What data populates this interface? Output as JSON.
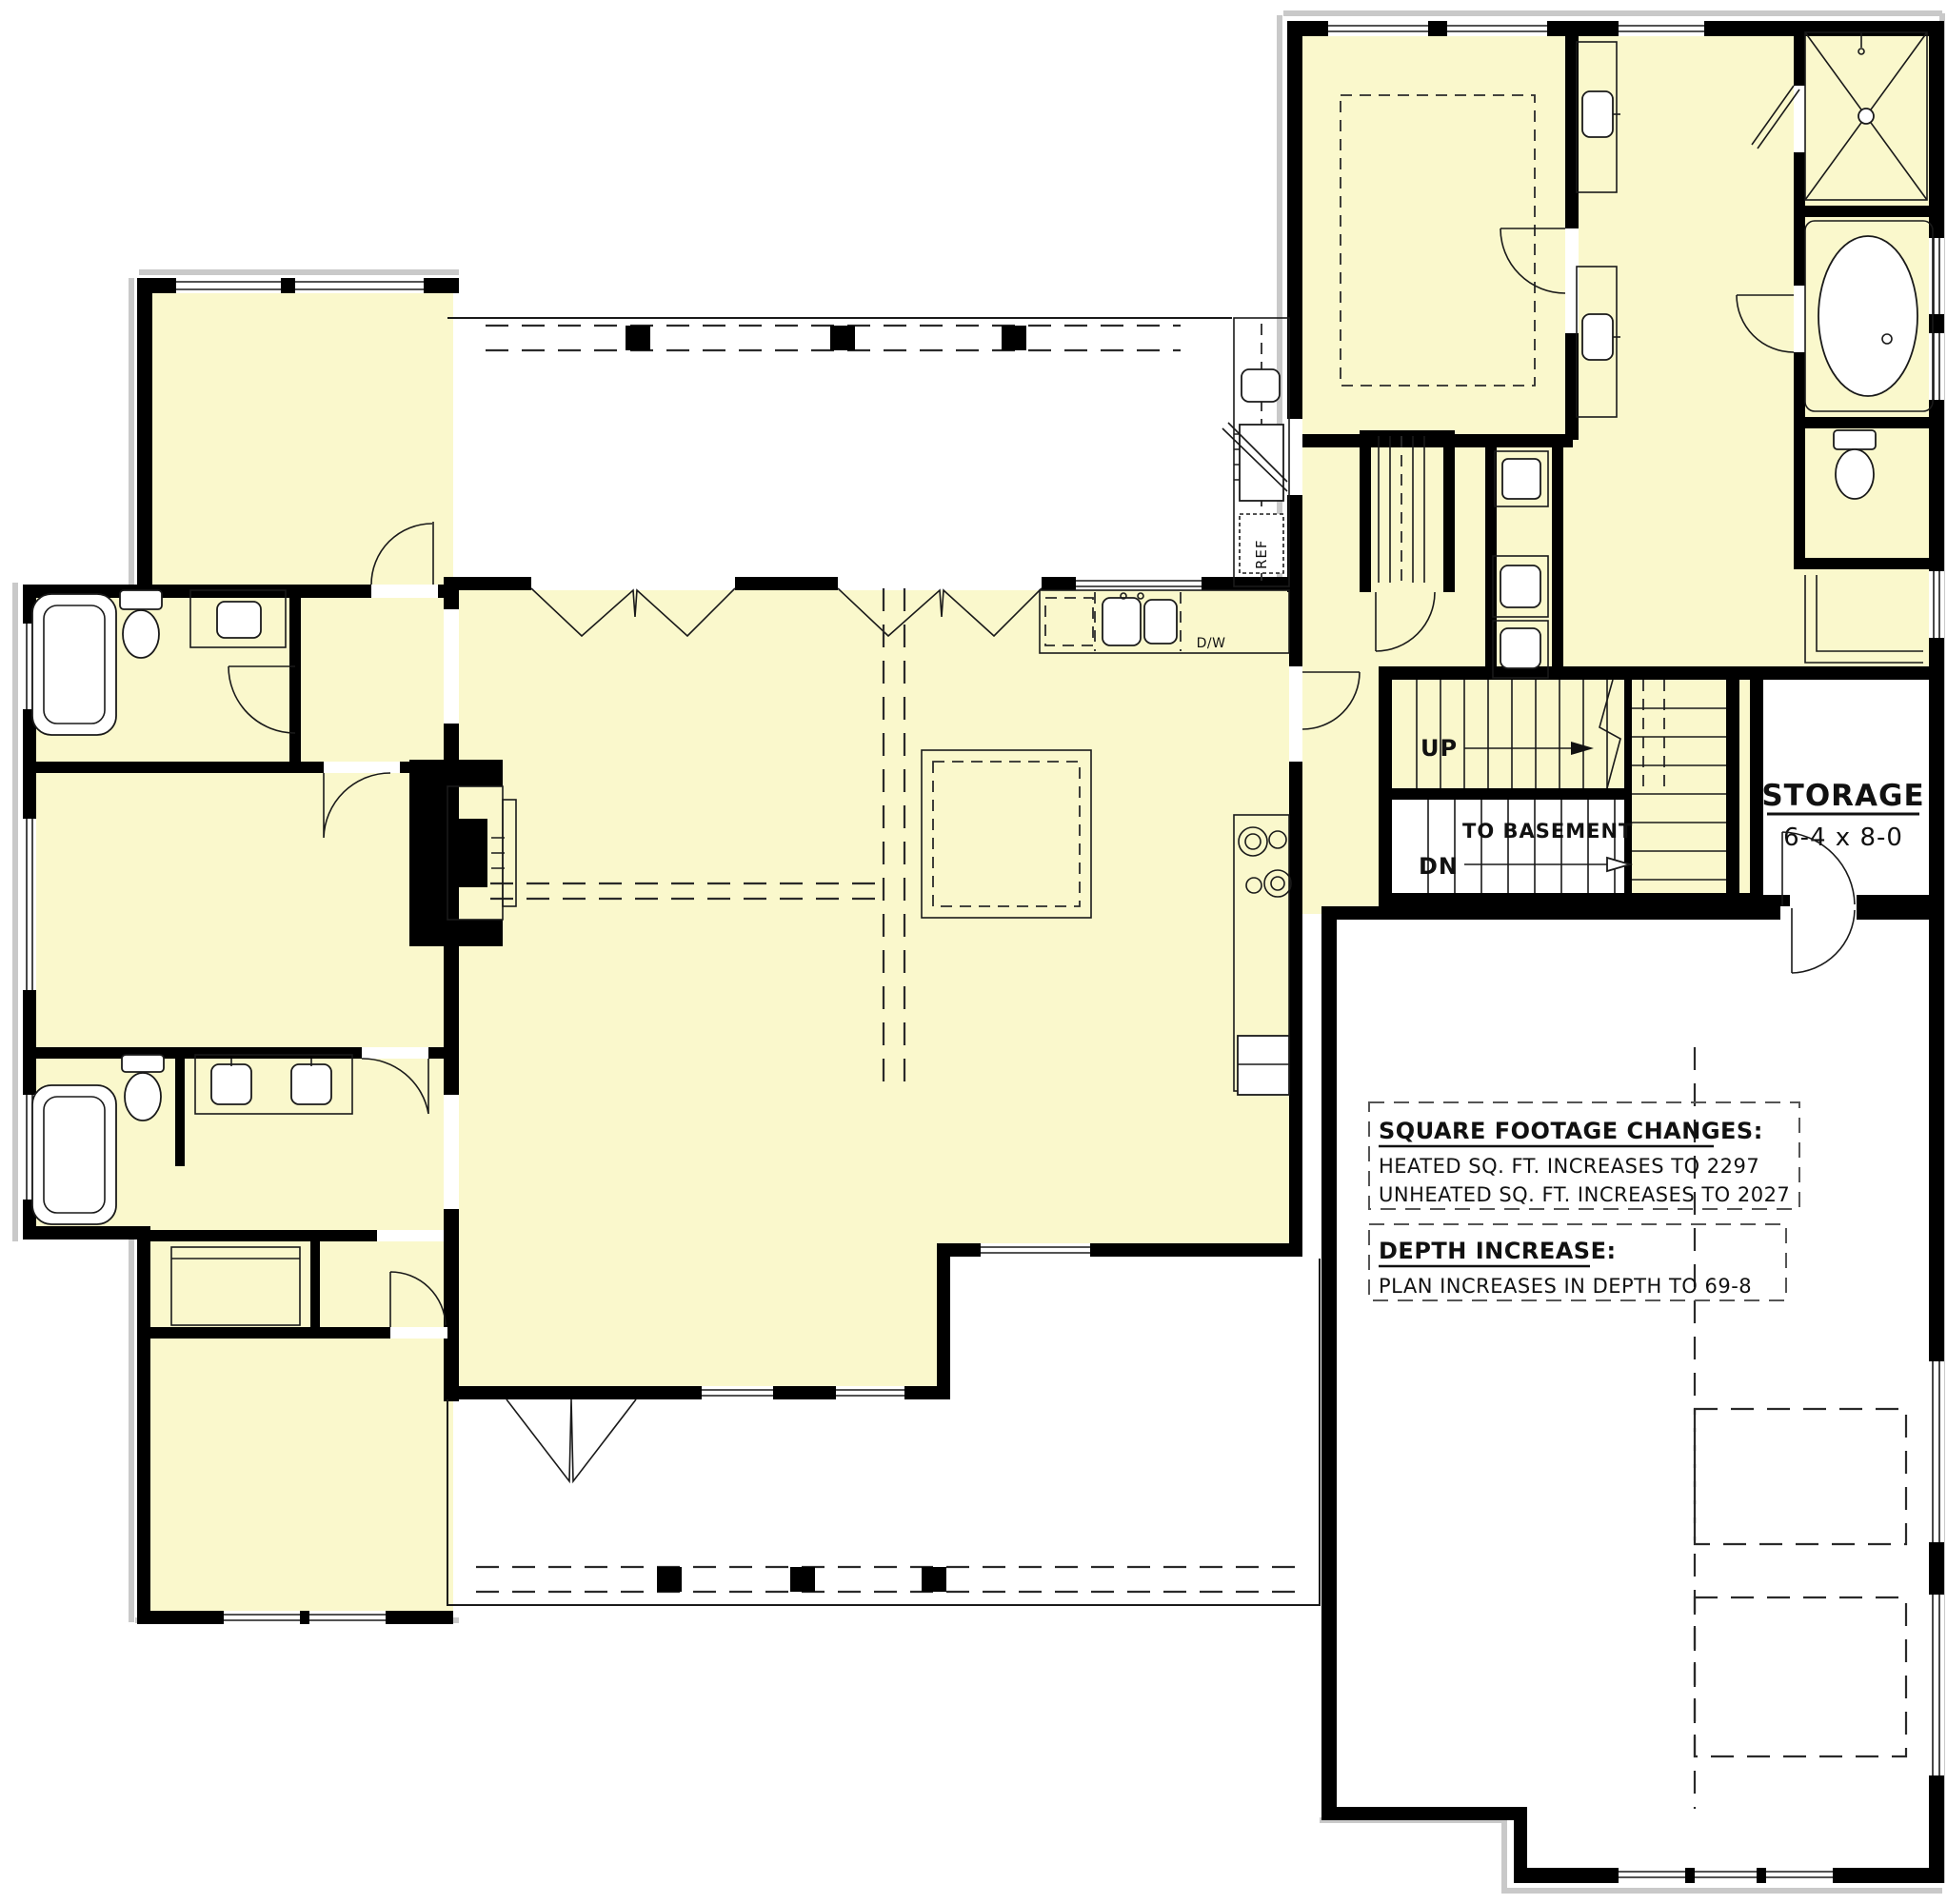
{
  "plan": {
    "stairs": {
      "up": "UP",
      "down": "DN",
      "to_basement": "TO BASEMENT"
    },
    "kitchen": {
      "dishwasher": "D/W"
    },
    "outdoor_kitchen": {
      "refrigerator": "REF"
    },
    "storage": {
      "name": "STORAGE",
      "dimensions": "6-4 x 8-0"
    },
    "notes": {
      "square_footage": {
        "heading": "SQUARE FOOTAGE CHANGES:",
        "line1": "HEATED SQ. FT. INCREASES TO 2297",
        "line2": "UNHEATED SQ. FT. INCREASES TO 2027"
      },
      "depth": {
        "heading": "DEPTH INCREASE:",
        "line1": "PLAN INCREASES IN DEPTH TO 69-8"
      }
    },
    "colors": {
      "room_fill": "#FAF8CC",
      "wall": "#000000",
      "line": "#1A1A1A",
      "background": "#FFFFFF"
    }
  }
}
